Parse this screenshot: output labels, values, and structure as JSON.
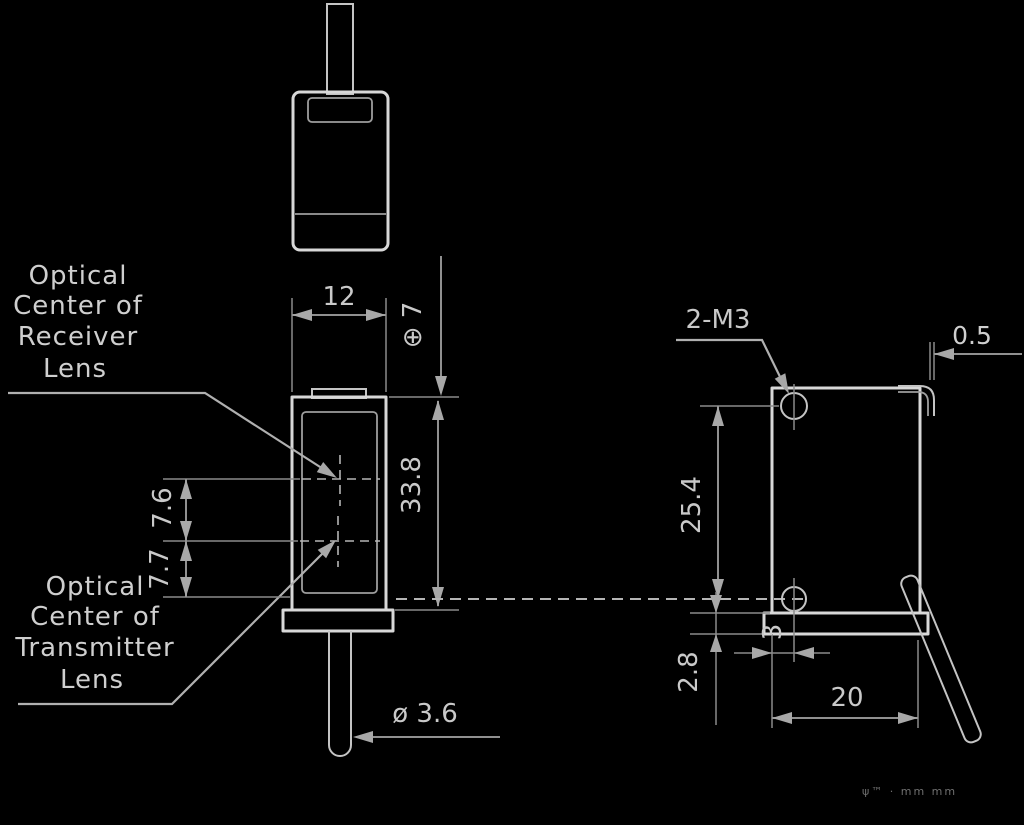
{
  "colors": {
    "background": "#000000",
    "outline": "#d8d8d8",
    "dimension_lines": "#909090",
    "text": "#cfcfcf",
    "fine_print": "#6f6f6f"
  },
  "notes": {
    "receiver": {
      "line1": "Optical",
      "line2": "Center of",
      "line3": "Receiver",
      "line4": "Lens"
    },
    "transmitter": {
      "line1": "Optical",
      "line2": "Center of",
      "line3": "Transmitter",
      "line4": "Lens"
    }
  },
  "dimensions": {
    "front_width": "12",
    "top_to_receiver_center": "⊕ 7",
    "front_height": "33.8",
    "receiver_to_transmitter": "7.6",
    "transmitter_to_axis": "7.7",
    "cable_diameter": "ø 3.6",
    "mounting_holes": "2-M3",
    "tab_thickness": "0.5",
    "hole_spacing": "25.4",
    "base_thickness": "2.8",
    "hole_to_face": "3",
    "body_depth": "20"
  },
  "fine_print": "ψ™ ·  mm mm"
}
